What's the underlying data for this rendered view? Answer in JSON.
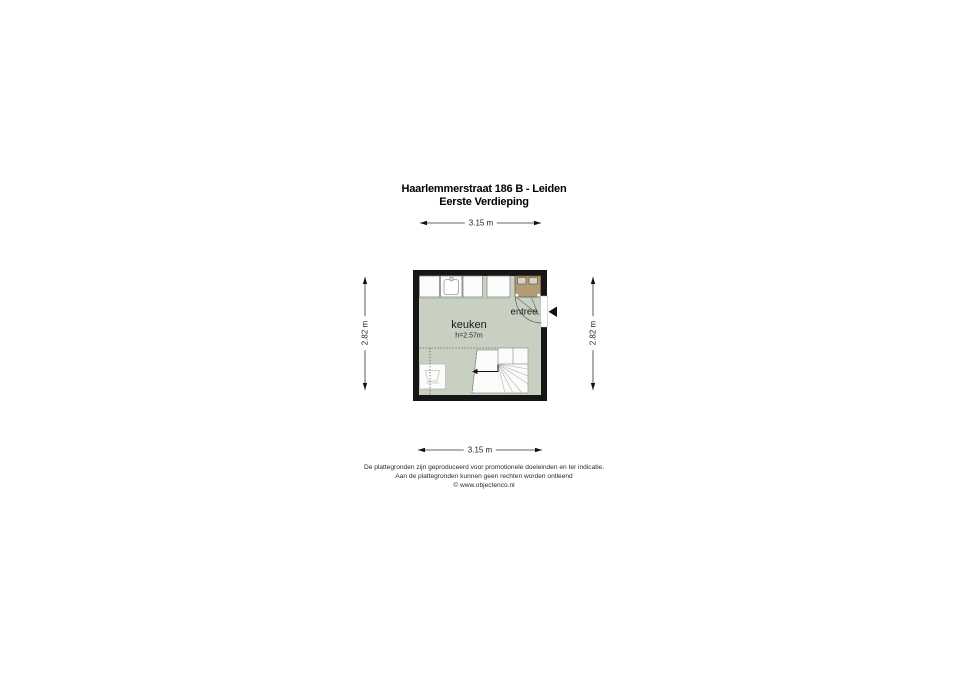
{
  "header": {
    "title": "Haarlemmerstraat 186 B - Leiden",
    "subtitle": "Eerste Verdieping"
  },
  "plan": {
    "room_label": "keuken",
    "room_height_label": "h=2.57m",
    "entry_label": "entree"
  },
  "dimensions": {
    "top": "3.15 m",
    "bottom": "3.15 m",
    "left": "2.82 m",
    "right": "2.82 m"
  },
  "footer": {
    "line1": "De plattegronden zijn geproduceerd voor promotionele doeleinden en ter indicatie.",
    "line2": "Aan de plattegronden kunnen geen rechten worden ontleend",
    "line3": "© www.objectenco.nl"
  },
  "colors": {
    "wall": "#161616",
    "floor": "#c8d0c2",
    "cabinet": "#b29a74",
    "fixture": "#d7d3c7",
    "unit_fill": "#fcfcfa"
  }
}
